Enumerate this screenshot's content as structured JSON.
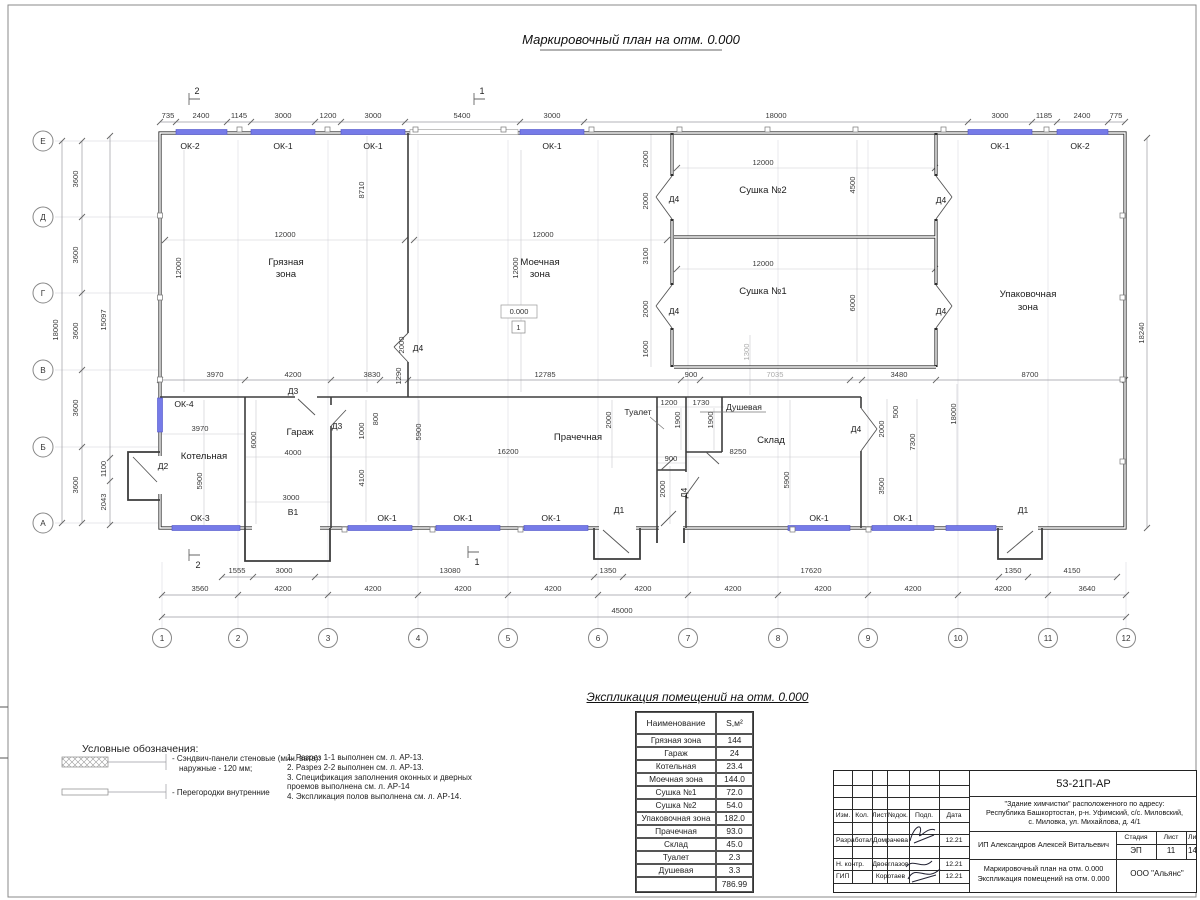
{
  "title": "Маркировочный план на отм. 0.000",
  "axes": {
    "cols": [
      "1",
      "2",
      "3",
      "4",
      "5",
      "6",
      "7",
      "8",
      "9",
      "10",
      "11",
      "12"
    ],
    "rows": [
      "Е",
      "Д",
      "Г",
      "В",
      "Б",
      "А"
    ]
  },
  "plan": {
    "rooms": {
      "gryaznaya1": "Грязная",
      "gryaznaya2": "зона",
      "moechnaya1": "Моечная",
      "moechnaya2": "зона",
      "sushka2": "Сушка №2",
      "sushka1": "Сушка №1",
      "upak1": "Упаковочная",
      "upak2": "зона",
      "kotelnaya": "Котельная",
      "garazh": "Гараж",
      "prachechnaya": "Прачечная",
      "tualet": "Туалет",
      "dushevaya": "Душевая",
      "sklad": "Склад"
    },
    "openings": {
      "ok1": "ОК-1",
      "ok2": "ОК-2",
      "ok3": "ОК-3",
      "ok4": "ОК-4",
      "d1": "Д1",
      "d2": "Д2",
      "d3": "Д3",
      "d4": "Д4",
      "v1": "В1"
    },
    "elevation": "0.000",
    "floor_mark": "1",
    "sections": {
      "s1": "1",
      "s2": "2"
    }
  },
  "dims": {
    "top": [
      "735",
      "2400",
      "1145",
      "3000",
      "1200",
      "3000",
      "5400",
      "3000",
      "18000",
      "3000",
      "1185",
      "2400",
      "775"
    ],
    "bottom1": [
      "1555",
      "3000",
      "13080",
      "1350",
      "17620",
      "1350",
      "4150"
    ],
    "bottom2": [
      "3560",
      "4200",
      "4200",
      "4200",
      "4200",
      "4200",
      "4200",
      "4200",
      "4200",
      "4200",
      "3640"
    ],
    "bottom_total": "45000",
    "left_axis": [
      "3600",
      "3600",
      "3600",
      "3600",
      "3600"
    ],
    "left_total": "18000",
    "left_inner": [
      "15097",
      "1100",
      "2043"
    ],
    "right_total": "18240",
    "inner": [
      "12000",
      "12000",
      "8710",
      "12000",
      "12000",
      "12000",
      "4500",
      "12000",
      "6000",
      "2000",
      "2000",
      "3100",
      "2000",
      "1600",
      "2000",
      "1290",
      "12785",
      "900",
      "7035",
      "3480",
      "8700",
      "1300",
      "3970",
      "4200",
      "3830",
      "3970",
      "800",
      "1000",
      "6000",
      "4000",
      "5900",
      "4100",
      "5900",
      "3000",
      "16200",
      "2000",
      "1200",
      "1730",
      "1900",
      "1900",
      "900",
      "2000",
      "8250",
      "5900",
      "500",
      "2000",
      "7300",
      "3500",
      "18000"
    ]
  },
  "legend": {
    "heading": "Условные обозначения:",
    "item1_line1": "- Сэндвич-панели стеновые (мин. вата):",
    "item1_line2": "наружные - 120 мм;",
    "item2": "- Перегородки внутренние"
  },
  "notes": [
    "1. Разрез 1-1 выполнен см. л. АР-13.",
    "2. Разрез 2-2 выполнен см. л. АР-13.",
    "3. Спецификация заполнения оконных и дверных",
    "проемов выполнена см. л. АР-14",
    "4. Экспликация полов выполнена см. л. АР-14."
  ],
  "table": {
    "title": "Экспликация помещений на отм. 0.000",
    "col_name": "Наименование",
    "col_area": "S,м²",
    "rows": [
      {
        "name": "Грязная зона",
        "area": "144"
      },
      {
        "name": "Гараж",
        "area": "24"
      },
      {
        "name": "Котельная",
        "area": "23.4"
      },
      {
        "name": "Моечная зона",
        "area": "144.0"
      },
      {
        "name": "Сушка №1",
        "area": "72.0"
      },
      {
        "name": "Сушка №2",
        "area": "54.0"
      },
      {
        "name": "Упаковочная зона",
        "area": "182.0"
      },
      {
        "name": "Прачечная",
        "area": "93.0"
      },
      {
        "name": "Склад",
        "area": "45.0"
      },
      {
        "name": "Туалет",
        "area": "2.3"
      },
      {
        "name": "Душевая",
        "area": "3.3"
      }
    ],
    "total": "786.99"
  },
  "titleblock": {
    "doc_code": "53-21П-АР",
    "address1": "\"Здание химчистки\" расположенного по адресу:",
    "address2": "Республика Башкортостан, р-н. Уфимский, с/с. Миловский,",
    "address3": "с. Миловка, ул. Михайлова, д. 4/1",
    "h_izm": "Изм.",
    "h_kol": "Кол.",
    "h_list": "Лист",
    "h_ndok": "№док.",
    "h_podp": "Подп.",
    "h_data": "Дата",
    "r1_role": "Разработал",
    "r1_name": "Домрачева",
    "r1_date": "12.21",
    "r2_role": "Н. контр.",
    "r2_name": "Двоеглазов",
    "r2_date": "12.21",
    "r3_role": "ГИП",
    "r3_name": "Коротаев",
    "r3_date": "12.21",
    "client": "ИП Александров Алексей Витальевич",
    "stage_label": "Стадия",
    "sheet_label": "Лист",
    "sheets_label": "Листов",
    "stage": "ЭП",
    "sheet_num": "11",
    "sheets_total": "14",
    "subtitle1": "Маркировочный план на отм. 0.000",
    "subtitle2": "Экспликация помещений на отм. 0.000",
    "company": "ООО \"Альянс\""
  }
}
